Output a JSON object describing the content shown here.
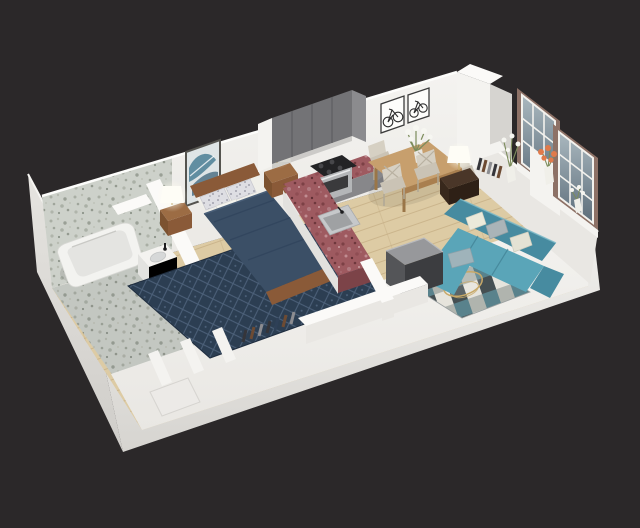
{
  "scene": {
    "type": "3d-isometric-floor-plan-render",
    "description": "Isometric dollhouse cutaway render of a studio apartment with bathroom, bedroom, kitchen, dining area, living room and entry closets on a dark background",
    "background": "#2b2829"
  },
  "colors": {
    "background": "#2b2829",
    "wall_bright": "#fbfaf8",
    "wall_light": "#f4f3f0",
    "wall_mid": "#e9e7e3",
    "wall_shadow": "#d6d4d0",
    "floor_wood": "#ddcba4",
    "floor_wood_line": "#c8b288",
    "tile_base": "#cdd1ca",
    "granite_counter": "#9e5a60",
    "granite_counter_dark": "#7c4348",
    "cabinet_gray": "#737376",
    "cabinet_gray_side": "#8b8b8e",
    "steel": "#b4b6b8",
    "cooktop_black": "#232325",
    "oven_glass": "#3a3a3c",
    "bed_wood": "#8a5a38",
    "duvet_navy": "#3b4f66",
    "rug_navy": "#2c3e52",
    "pillow_base": "#dedee3",
    "mattress_white": "#f0efe9",
    "art_teal": "#4b7f94",
    "art_teal_dark": "#2f5a70",
    "sofa_teal": "#5aa5b8",
    "sofa_teal_dark": "#478ba0",
    "rug_check_base": "#e6e4dc",
    "rug_check_dark": "#454f52",
    "rug_check_teal": "#59828c",
    "rug_check_gray": "#b0b4ae",
    "table_wood": "#c79f6d",
    "table_wood_edge": "#a97f4f",
    "chair_wood": "#d6d0c3",
    "side_table_brown": "#4a3628",
    "window_frame_brown": "#8d7166",
    "glass_top": "#aab8bf",
    "glass_bottom": "#5c6d7a",
    "mullion_white": "#f3f2ee",
    "flower_orange": "#e07a4b",
    "flower_white": "#f6f6f1",
    "leaf_green": "#7c8c5c",
    "lamp_white": "#fefdf6",
    "box_top": "#97989b",
    "box_side_light": "#545558",
    "box_side_dark": "#3c3d40",
    "tub_white": "#f3f3f0",
    "tub_inner": "#e4e4e1",
    "gold": "#c8a968",
    "book_dark": "#35353a"
  },
  "rooms": [
    {
      "name": "bathroom",
      "items": [
        "bathtub",
        "vanity-with-sink",
        "granite-tile-walls",
        "granite-tile-floor"
      ]
    },
    {
      "name": "bedroom",
      "items": [
        "double-bed",
        "navy-duvet",
        "speckled-pillows",
        "nightstand-left",
        "nightstand-right",
        "table-lamp-left",
        "table-lamp-right",
        "abstract-wall-art",
        "navy-diamond-rug"
      ]
    },
    {
      "name": "kitchen",
      "items": [
        "gray-upper-cabinets",
        "red-granite-l-counter",
        "cooktop-and-oven",
        "kitchen-sink"
      ]
    },
    {
      "name": "dining-area",
      "items": [
        "wood-dining-table",
        "four-crossback-chairs",
        "white-flower-centerpiece",
        "two-bicycle-art-frames"
      ]
    },
    {
      "name": "living-room",
      "items": [
        "teal-sectional-sofa",
        "checkered-rug",
        "gold-coffee-table",
        "dark-media-cabinet",
        "side-table-with-lamp",
        "two-paned-windows",
        "flower-vases",
        "console-books"
      ]
    },
    {
      "name": "hallway-entry",
      "items": [
        "closet-partitions",
        "closet-shelf-items",
        "entry-door"
      ]
    }
  ]
}
